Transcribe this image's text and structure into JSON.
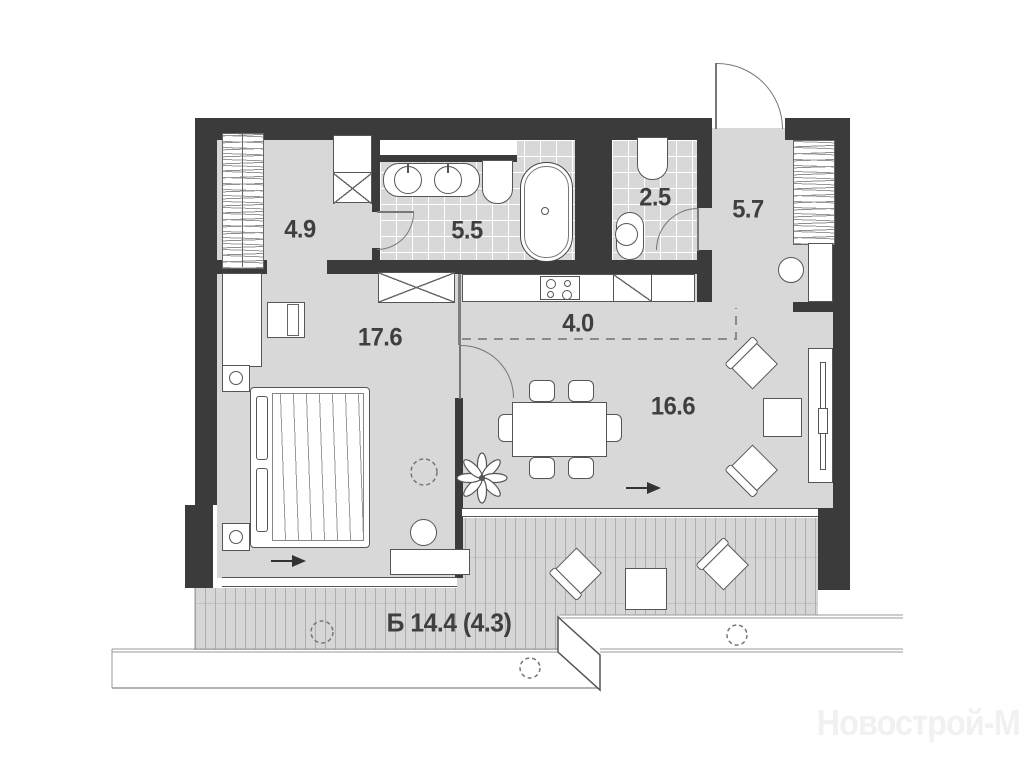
{
  "watermark": "Новострой-М",
  "palette": {
    "wall": "#3b3b3b",
    "floor": "#d8d8d8",
    "deck": "#d6d6d6",
    "outline": "#555555",
    "label_color": "#3f3f3f",
    "watermark_color": "#f1f1f1"
  },
  "rooms": [
    {
      "id": "dressing-room",
      "area_label": "4.9"
    },
    {
      "id": "bathroom",
      "area_label": "5.5"
    },
    {
      "id": "wc",
      "area_label": "2.5"
    },
    {
      "id": "hallway",
      "area_label": "5.7"
    },
    {
      "id": "bedroom",
      "area_label": "17.6"
    },
    {
      "id": "kitchen",
      "area_label": "4.0"
    },
    {
      "id": "living-room",
      "area_label": "16.6"
    },
    {
      "id": "balcony",
      "area_label": "Б 14.4 (4.3)"
    }
  ],
  "furniture": [
    "entrance-door",
    "hatched-wardrobe",
    "crossed-closet",
    "double-sink-vanity",
    "toilet",
    "bathtub",
    "washbasin",
    "washing-machine",
    "cooktop",
    "kitchen-counter",
    "dining-table",
    "dining-chair",
    "armchair",
    "side-table",
    "tv-console",
    "tv",
    "pouf",
    "desk-with-chair",
    "wardrobe",
    "nightstand",
    "double-bed",
    "bench",
    "floor-lamp",
    "plant",
    "ceiling-light",
    "balcony-deck",
    "stairs",
    "direction-arrow",
    "window"
  ]
}
